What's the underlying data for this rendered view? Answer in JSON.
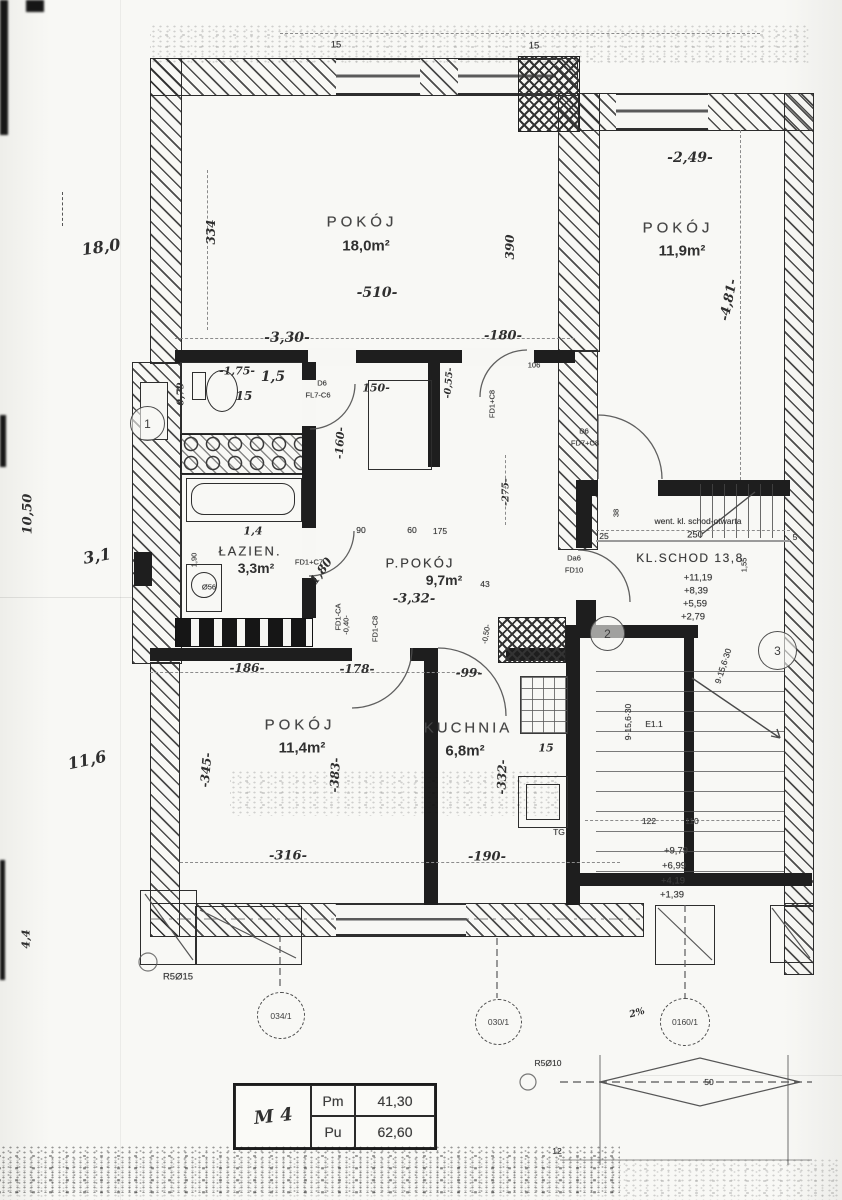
{
  "rooms": {
    "pokoj_top_left": {
      "name": "POKÓJ",
      "area": "18,0m²"
    },
    "pokoj_top_right": {
      "name": "POKÓJ",
      "area": "11,9m²"
    },
    "pokoj_bottom": {
      "name": "POKÓJ",
      "area": "11,4m²"
    },
    "kuchnia": {
      "name": "KUCHNIA",
      "area": "6,8m²"
    },
    "lazienka": {
      "name": "ŁAZIEN.",
      "area": "3,3m²"
    },
    "ppokoj": {
      "name": "P.POKÓJ",
      "area": "9,7m²"
    },
    "wc": {
      "area": "1,5",
      "width": "15"
    },
    "klschod": {
      "name": "KL.SCHOD 13,8",
      "vent_note": "went. kl. schod-otwarta",
      "width": "250",
      "levels": [
        "+11,19",
        "+8,39",
        "+5,59",
        "+2,79"
      ]
    }
  },
  "dimensions": {
    "d334": "334",
    "d510": "-510-",
    "d330": "-3,30-",
    "d180": "-180-",
    "d390": "390",
    "d249": "-2,49-",
    "d481": "-4,81-",
    "w15a": "15",
    "w15b": "15",
    "d175": "-1,75-",
    "hw15": "1,5",
    "hw15b": "15",
    "d079": "-0,79-",
    "d150": "150-",
    "d160": "-160-",
    "d055": "-0,55-",
    "d106": "106",
    "d90": "90",
    "d60": "60",
    "d175b": "175",
    "d275": "-275-",
    "d43": "43",
    "d332": "-3,32-",
    "d190v": "1,90",
    "dia180": "1,80",
    "hw14": "1,4",
    "o56": "Ø56",
    "d040": "-0,40-",
    "d050": "-0,50-",
    "d25": "25",
    "d38": "38",
    "d5": "5",
    "d155": "1,55",
    "d186": "-186-",
    "d178": "-178-",
    "d99": "-99-",
    "d345": "-345-",
    "d383": "-383-",
    "d316": "-316-",
    "d332v": "-332-",
    "d190": "-190-",
    "d122": "122",
    "d110": "110",
    "d12": "12",
    "k15": "15",
    "tg": "TG"
  },
  "stairs_lower": {
    "label": "E1.1",
    "formula": "9·15,6·30",
    "formula2": "9·15,6·30",
    "levels": [
      "+9,79",
      "+6,99",
      "+4,19",
      "+1,39"
    ]
  },
  "margin_notes": {
    "n180": "18,0",
    "n1050": "10,50",
    "n31": "3,1",
    "n116": "11,6",
    "n44": "4,4"
  },
  "axis_bubbles": {
    "b1": "1",
    "b2": "2",
    "b3": "3",
    "b034": "034/1",
    "b030": "030/1",
    "b0160": "0160/1"
  },
  "door_labels": {
    "dl1a": "D6",
    "dl1b": "FL7-C6",
    "dl2a": "D6",
    "dl2b": "FD7+C8",
    "dl3": "FD1+C8",
    "dl4": "FD1+C7",
    "dl5": "FD1-C8",
    "dl6a": "Da6",
    "dl6b": "FD10",
    "dl7": "FD1-CA"
  },
  "annotations": {
    "rs15": "R5Ø15",
    "r510": "R5Ø10",
    "pct2": "2%",
    "d50": "50"
  },
  "legend": {
    "unit": "M 4",
    "rows": [
      {
        "k": "Pm",
        "v": "41,30"
      },
      {
        "k": "Pu",
        "v": "62,60"
      }
    ]
  }
}
